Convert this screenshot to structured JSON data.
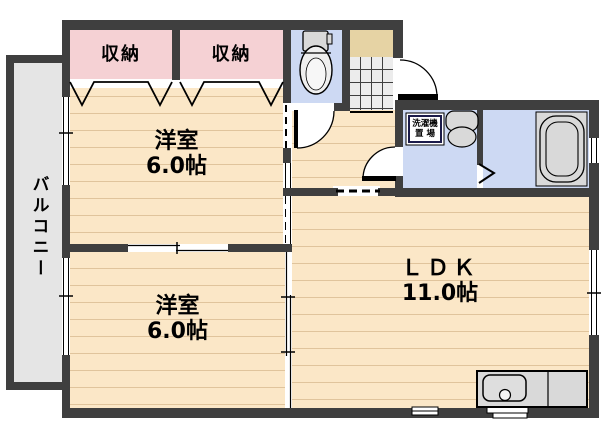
{
  "rooms": {
    "balcony": {
      "label": "バルコニー"
    },
    "closets": [
      {
        "label": "収納"
      },
      {
        "label": "収納"
      }
    ],
    "bedroom_top": {
      "label": "洋室",
      "area": "6.0帖"
    },
    "bedroom_bottom": {
      "label": "洋室",
      "area": "6.0帖"
    },
    "ldk": {
      "label": "ＬＤＫ",
      "area": "11.0帖"
    },
    "laundry": {
      "line1": "洗濯機",
      "line2": "置 場"
    }
  },
  "colors": {
    "wall": "#3f3f3f",
    "wood_floor": "#fbe7c7",
    "wood_stripe": "#e0c49c",
    "closet_pink": "#f5d1d4",
    "wet_area_blue": "#cdd9f3",
    "balcony_gray": "#e5e5e5",
    "entrance_tile": "#ececec",
    "entrance_step": "#e6d3a4",
    "fixture_gray": "#d9d9d9"
  }
}
